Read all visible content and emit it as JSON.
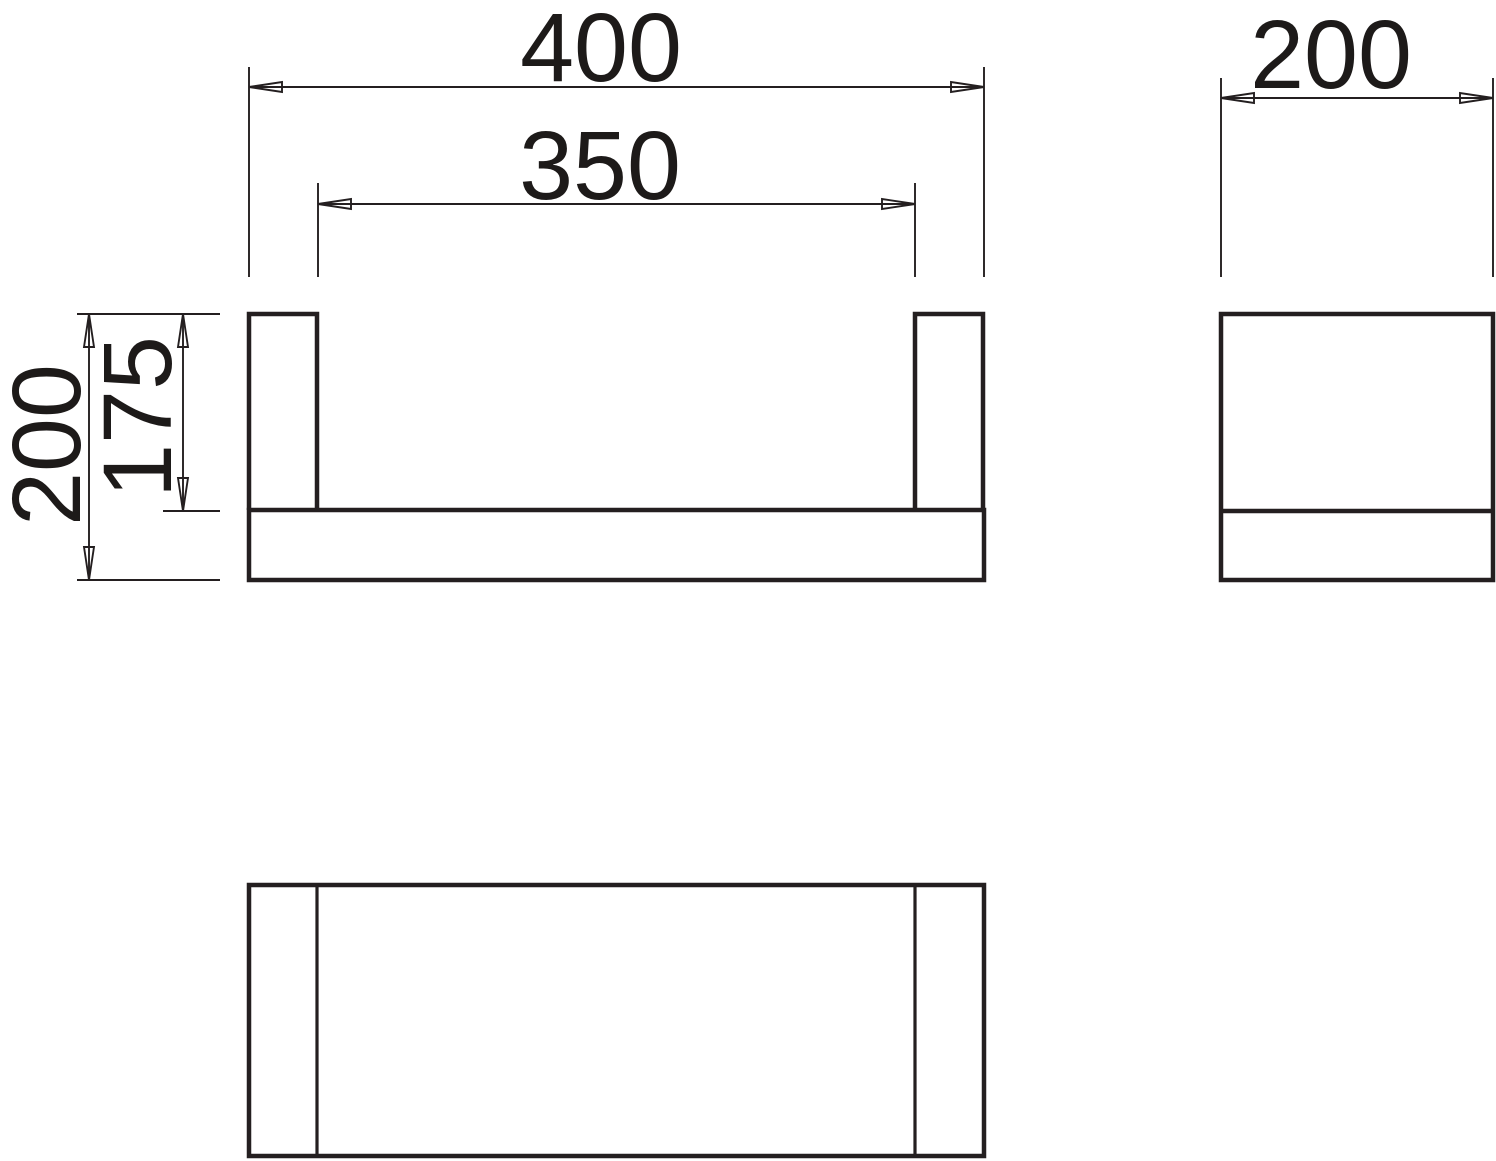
{
  "drawing": {
    "background_color": "#ffffff",
    "line_color": "#241f20",
    "dimensions": {
      "overall_width": "400",
      "inner_span": "350",
      "side_depth": "200",
      "overall_height": "200",
      "post_height": "175"
    }
  }
}
